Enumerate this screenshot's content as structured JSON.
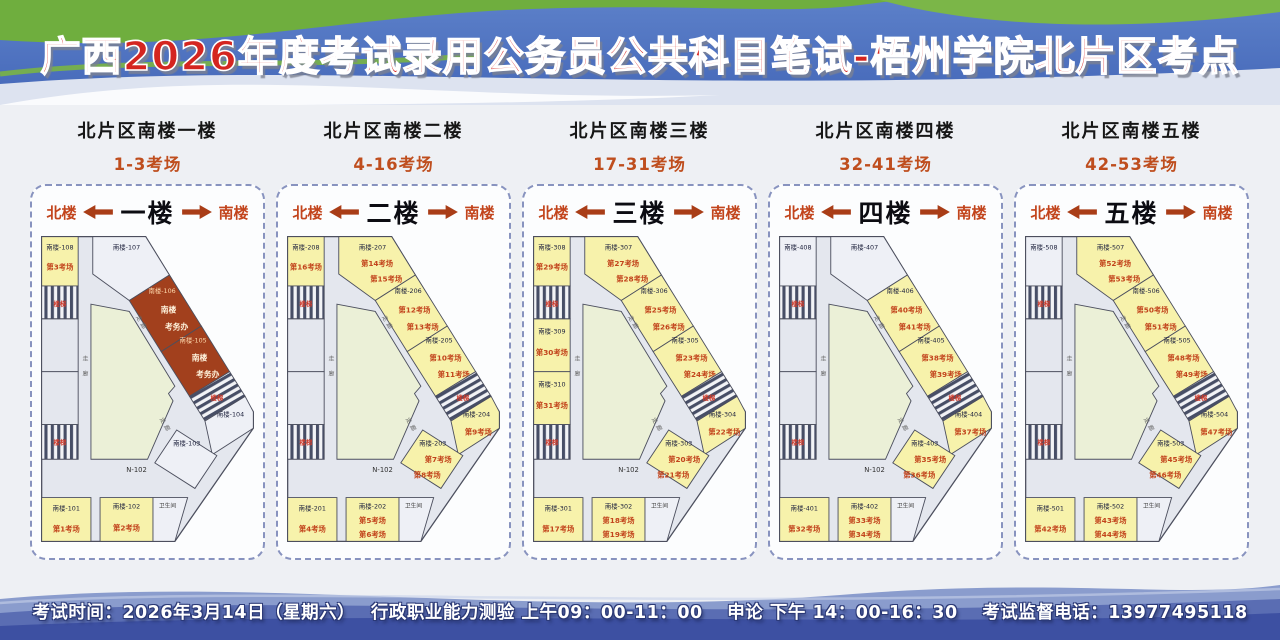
{
  "title": "广西2026年度考试录用公务员公共科目笔试-梧州学院北片区考点",
  "footer": {
    "text": "考试时间：2026年3月14日（星期六）　 行政职业能力测验 上午09：00-11：00　 申论 下午 14：00-16：30　 考试监督电话：13977495118"
  },
  "labels": {
    "north": "北楼",
    "south": "南楼",
    "corridor": "走廊",
    "stairs": "楼梯",
    "toilet": "卫生间",
    "hall": "N-102"
  },
  "colors": {
    "banner_blue": "#4f72bf",
    "banner_green": "#6fae3e",
    "title_red": "#d42520",
    "accent_red": "#c2441c",
    "exam_fill": "#f7f2ab",
    "plain_fill": "#eef0f6",
    "bg_fill": "#e4e7ee",
    "office_fill": "#a2401d",
    "courtyard_fill": "#ebf0d7",
    "wall": "#4c4f5e",
    "stripe_dark": "#474e66",
    "footer_blue": "#3d50a2"
  },
  "floors": [
    {
      "section_title": "北片区南楼一楼",
      "range": "1-3考场",
      "floor_name": "一楼",
      "show_hall": true,
      "rooms": {
        "topLeft": {
          "num": "南楼-108",
          "type": "exam",
          "exams": [
            "第3考场"
          ]
        },
        "topMid": {
          "num": "南楼-107",
          "type": "plain"
        },
        "band1": {
          "num": "南楼-106",
          "type": "office",
          "lines": [
            "南楼",
            "考务办"
          ]
        },
        "band2": {
          "num": "南楼-105",
          "type": "office",
          "lines": [
            "南楼",
            "考务办"
          ]
        },
        "right1": {
          "num": "南楼-104",
          "type": "plain"
        },
        "right2": {
          "num": "南楼-103",
          "type": "plain"
        },
        "b1": {
          "num": "南楼-101",
          "type": "exam",
          "exams": [
            "第1考场"
          ]
        },
        "b2": {
          "num": "南楼-102",
          "type": "exam",
          "exams": [
            "第2考场"
          ]
        }
      }
    },
    {
      "section_title": "北片区南楼二楼",
      "range": "4-16考场",
      "floor_name": "二楼",
      "show_hall": true,
      "rooms": {
        "topLeft": {
          "num": "南楼-208",
          "type": "exam",
          "exams": [
            "第16考场"
          ]
        },
        "topMid": {
          "num": "南楼-207",
          "type": "exam",
          "exams": [
            "第14考场",
            "第15考场"
          ]
        },
        "band1": {
          "num": "南楼-206",
          "type": "exam",
          "exams": [
            "第12考场",
            "第13考场"
          ]
        },
        "band2": {
          "num": "南楼-205",
          "type": "exam",
          "exams": [
            "第10考场",
            "第11考场"
          ]
        },
        "right1": {
          "num": "南楼-204",
          "type": "exam",
          "exams": [
            "第9考场"
          ]
        },
        "right2": {
          "num": "南楼-203",
          "type": "exam",
          "exams": [
            "第7考场",
            "第8考场"
          ]
        },
        "b1": {
          "num": "南楼-201",
          "type": "exam",
          "exams": [
            "第4考场"
          ]
        },
        "b2": {
          "num": "南楼-202",
          "type": "exam",
          "exams": [
            "第5考场",
            "第6考场"
          ]
        }
      }
    },
    {
      "section_title": "北片区南楼三楼",
      "range": "17-31考场",
      "floor_name": "三楼",
      "show_hall": true,
      "rooms": {
        "topLeft": {
          "num": "南楼-308",
          "type": "exam",
          "exams": [
            "第29考场"
          ]
        },
        "topMid": {
          "num": "南楼-307",
          "type": "exam",
          "exams": [
            "第27考场",
            "第28考场"
          ]
        },
        "band1": {
          "num": "南楼-306",
          "type": "exam",
          "exams": [
            "第25考场",
            "第26考场"
          ]
        },
        "band2": {
          "num": "南楼-305",
          "type": "exam",
          "exams": [
            "第23考场",
            "第24考场"
          ]
        },
        "right1": {
          "num": "南楼-304",
          "type": "exam",
          "exams": [
            "第22考场"
          ]
        },
        "right2": {
          "num": "南楼-303",
          "type": "exam",
          "exams": [
            "第20考场",
            "第21考场"
          ]
        },
        "mid1": {
          "num": "南楼-309",
          "type": "exam",
          "exams": [
            "第30考场"
          ]
        },
        "mid2": {
          "num": "南楼-310",
          "type": "exam",
          "exams": [
            "第31考场"
          ]
        },
        "b1": {
          "num": "南楼-301",
          "type": "exam",
          "exams": [
            "第17考场"
          ]
        },
        "b2": {
          "num": "南楼-302",
          "type": "exam",
          "exams": [
            "第18考场",
            "第19考场"
          ]
        }
      }
    },
    {
      "section_title": "北片区南楼四楼",
      "range": "32-41考场",
      "floor_name": "四楼",
      "show_hall": true,
      "rooms": {
        "topLeft": {
          "num": "南楼-408",
          "type": "plain"
        },
        "topMid": {
          "num": "南楼-407",
          "type": "plain"
        },
        "band1": {
          "num": "南楼-406",
          "type": "exam",
          "exams": [
            "第40考场",
            "第41考场"
          ]
        },
        "band2": {
          "num": "南楼-405",
          "type": "exam",
          "exams": [
            "第38考场",
            "第39考场"
          ]
        },
        "right1": {
          "num": "南楼-404",
          "type": "exam",
          "exams": [
            "第37考场"
          ]
        },
        "right2": {
          "num": "南楼-403",
          "type": "exam",
          "exams": [
            "第35考场",
            "第36考场"
          ]
        },
        "b1": {
          "num": "南楼-401",
          "type": "exam",
          "exams": [
            "第32考场"
          ]
        },
        "b2": {
          "num": "南楼-402",
          "type": "exam",
          "exams": [
            "第33考场",
            "第34考场"
          ]
        }
      }
    },
    {
      "section_title": "北片区南楼五楼",
      "range": "42-53考场",
      "floor_name": "五楼",
      "show_hall": false,
      "rooms": {
        "topLeft": {
          "num": "南楼-508",
          "type": "plain"
        },
        "topMid": {
          "num": "南楼-507",
          "type": "exam",
          "exams": [
            "第52考场",
            "第53考场"
          ]
        },
        "band1": {
          "num": "南楼-506",
          "type": "exam",
          "exams": [
            "第50考场",
            "第51考场"
          ]
        },
        "band2": {
          "num": "南楼-505",
          "type": "exam",
          "exams": [
            "第48考场",
            "第49考场"
          ]
        },
        "right1": {
          "num": "南楼-504",
          "type": "exam",
          "exams": [
            "第47考场"
          ]
        },
        "right2": {
          "num": "南楼-503",
          "type": "exam",
          "exams": [
            "第45考场",
            "第46考场"
          ]
        },
        "b1": {
          "num": "南楼-501",
          "type": "exam",
          "exams": [
            "第42考场"
          ]
        },
        "b2": {
          "num": "南楼-502",
          "type": "exam",
          "exams": [
            "第43考场",
            "第44考场"
          ]
        }
      }
    }
  ]
}
